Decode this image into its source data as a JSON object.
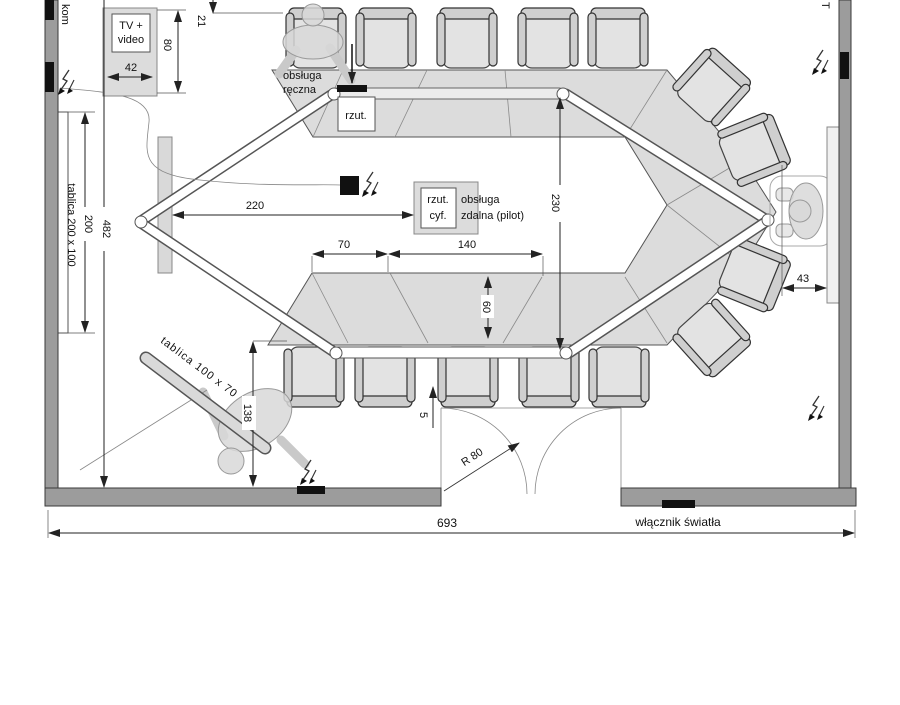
{
  "title": "Plan sali konferencyjnej",
  "labels": {
    "kom": "kom",
    "t_partial": "T",
    "tv_line1": "TV +",
    "tv_line2": "video",
    "obsluga_reczna_line1": "obsługa",
    "obsluga_reczna_line2": "ręczna",
    "rzut": "rzut.",
    "rzut_cyf_line1": "rzut.",
    "rzut_cyf_line2": "cyf.",
    "obsluga_zdalna_line1": "obsługa",
    "obsluga_zdalna_line2": "zdalna (pilot)",
    "tablica_200": "tablica 200 x 100",
    "tablica_100": "tablica 100 x 70",
    "r80": "R 80",
    "wlacznik_swiatla": "włącznik światła"
  },
  "dimensions": {
    "d21": "21",
    "d42": "42",
    "d80": "80",
    "d200": "200",
    "d482": "482",
    "d220": "220",
    "d230": "230",
    "d70": "70",
    "d140": "140",
    "d60": "60",
    "d5": "5",
    "d138": "138",
    "d43": "43",
    "d693": "693"
  },
  "colors": {
    "wall": "#9c9c9c",
    "wall_edge": "#3a3a3a",
    "table": "#dcdcdc",
    "chair": "#e3e3e3",
    "line": "#222222",
    "person": "#d8d8d8",
    "background": "#ffffff"
  }
}
